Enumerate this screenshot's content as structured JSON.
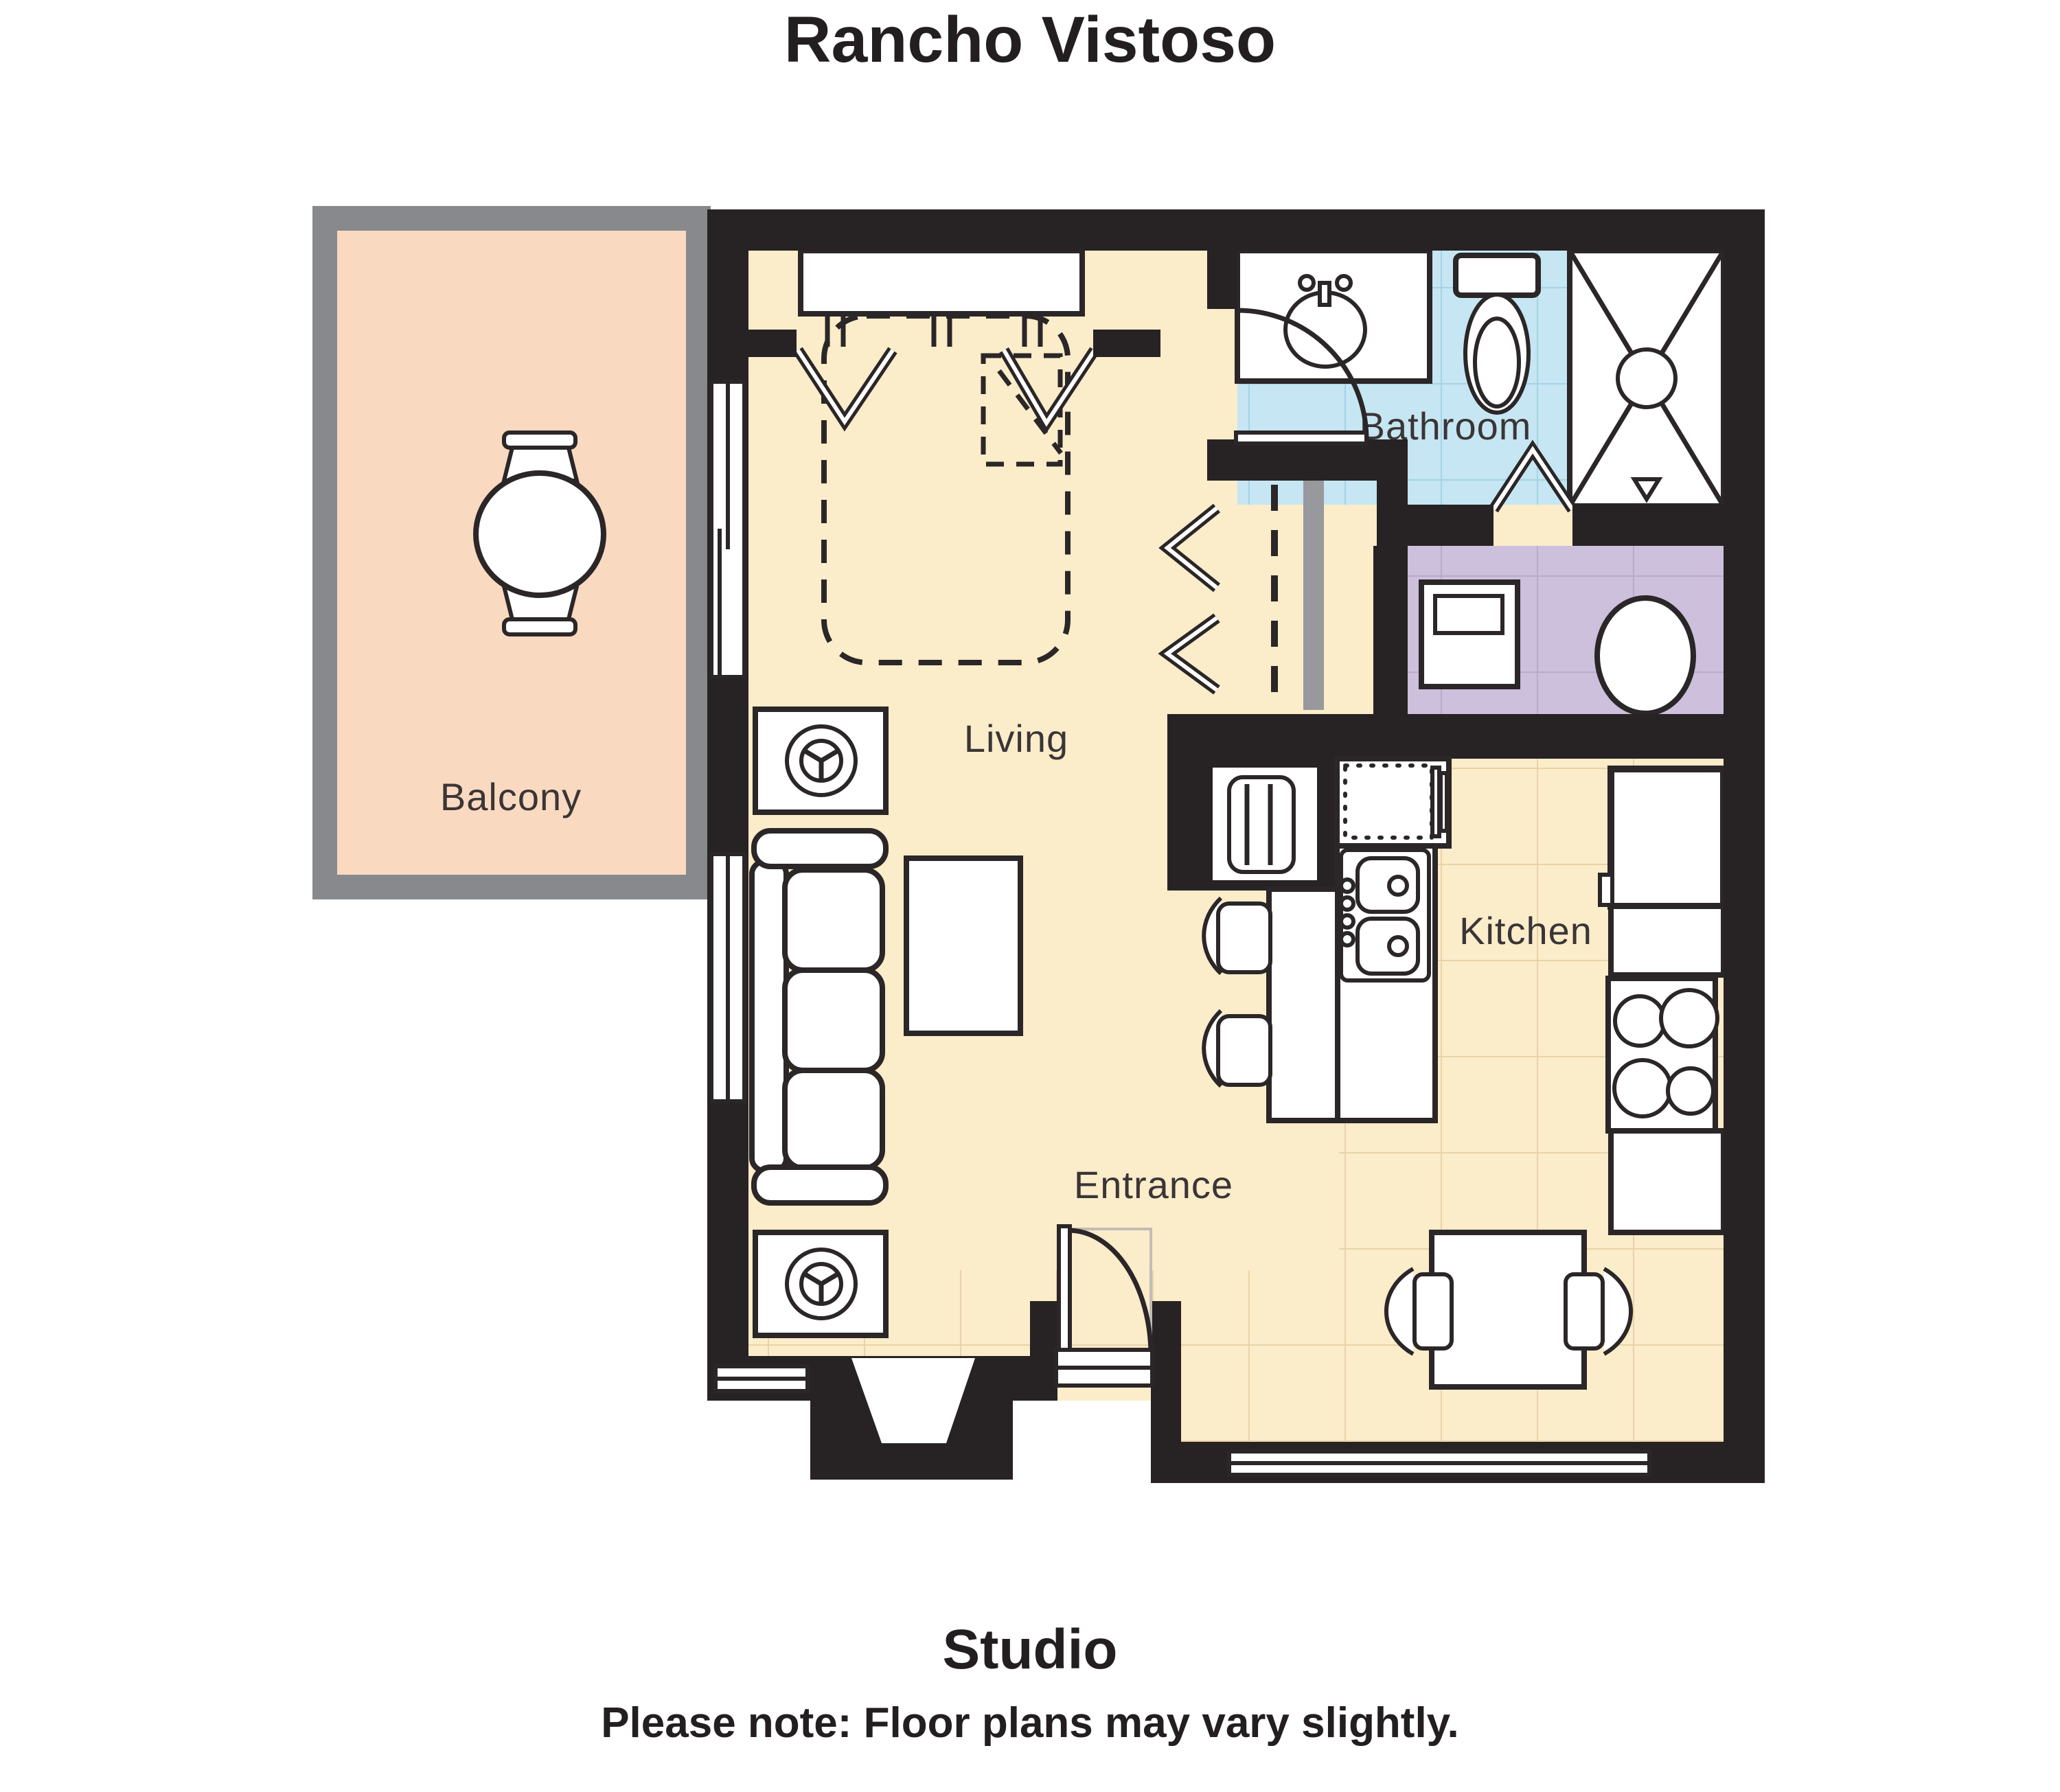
{
  "title": "Rancho Vistoso",
  "rooms": {
    "balcony": {
      "label": "Balcony",
      "floor_color": "#f9d9c0"
    },
    "living": {
      "label": "Living",
      "floor_color": "#fbecca"
    },
    "bathroom": {
      "label": "Bathroom",
      "floor_color": "#c5e6f2"
    },
    "kitchen": {
      "label": "Kitchen",
      "floor_color": "#fbecca"
    },
    "entrance": {
      "label": "Entrance"
    },
    "laundry": {
      "floor_color": "#ccc0dc"
    }
  },
  "footer": {
    "unit_type": "Studio",
    "note": "Please note: Floor plans may vary slightly."
  },
  "colors": {
    "wall": "#272223",
    "balcony_wall": "#87898c",
    "outline": "#2b2627",
    "label_text": "#3a3536",
    "grid_warm": "#ead2a8",
    "grid_blue": "#a5d2e6",
    "grid_purple": "#b7aacd",
    "pocket_gray": "#97999c",
    "swing_faint": "#c2bcb6"
  }
}
